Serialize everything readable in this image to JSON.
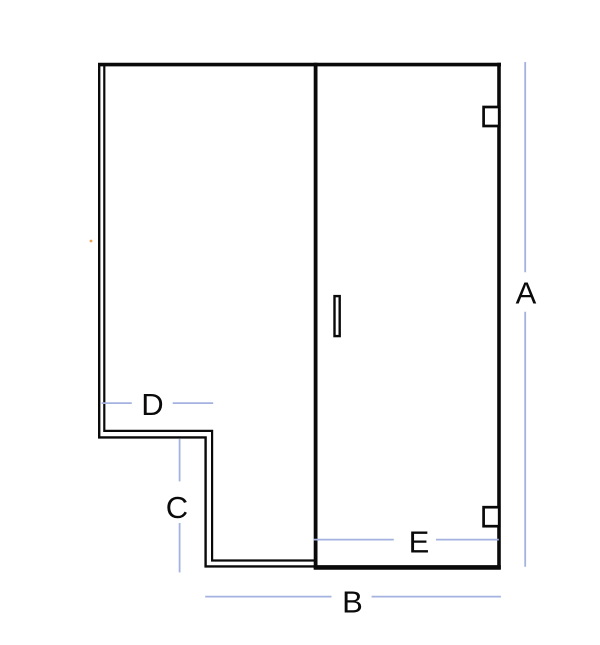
{
  "labels": {
    "a": "A",
    "b": "B",
    "c": "C",
    "d": "D",
    "e": "E"
  },
  "colors": {
    "line": "#0a0a0a",
    "dimension_line": "#a4b2e0",
    "background": "#ffffff",
    "speck": "#f0a050"
  }
}
